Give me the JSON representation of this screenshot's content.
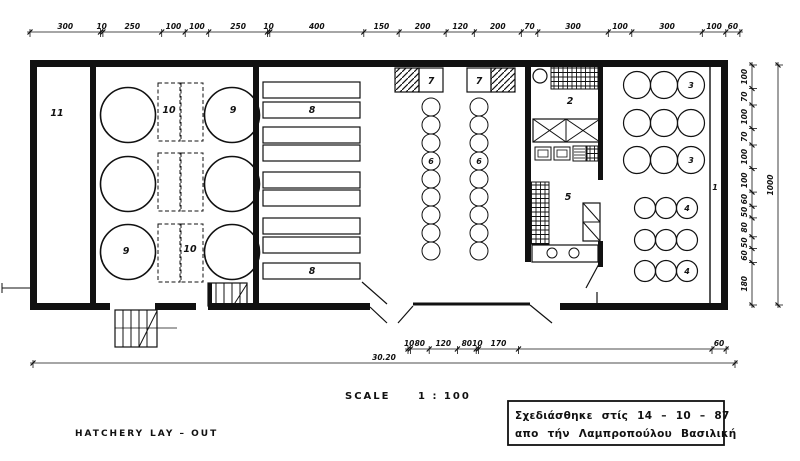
{
  "drawing": {
    "title_left": "HATCHERY",
    "title_right": "LAY – OUT",
    "scale_label": "SCALE",
    "scale_value": "1 : 100"
  },
  "note_box": {
    "line1": "Σχεδιάσθηκε στίς 14 – 10 – 87",
    "line2": "απο τήν Λαμπροπούλου Βασιλική"
  },
  "dimensions": {
    "top": [
      "300",
      "10",
      "250",
      "100",
      "100",
      "250",
      "10",
      "400",
      "150",
      "200",
      "120",
      "200",
      "70",
      "300",
      "100",
      "300",
      "100",
      "60"
    ],
    "right_segments": [
      "100",
      "70",
      "100",
      "70",
      "100",
      "100",
      "60",
      "50",
      "80",
      "50",
      "60",
      "180"
    ],
    "right_overall": "1000",
    "bottom_segments": [
      "10",
      "80",
      "120",
      "80",
      "10",
      "170",
      "",
      "60"
    ],
    "bottom_overall": "30.20"
  },
  "room_labels": {
    "room_11": "11",
    "tank_top_right": "9",
    "tank_bottom_left": "9",
    "rack_top": "10",
    "rack_bottom": "10",
    "trough_top": "8",
    "trough_bottom": "8",
    "tray_left": "7",
    "tray_right": "7",
    "jar_left": "6",
    "jar_right": "6",
    "room_2": "2",
    "room_5": "5",
    "pool3_top": "3",
    "pool3_bottom": "3",
    "pool4_top": "4",
    "pool4_bottom": "4",
    "channel": "1"
  },
  "colors": {
    "ink": "#111111",
    "paper": "#ffffff"
  }
}
